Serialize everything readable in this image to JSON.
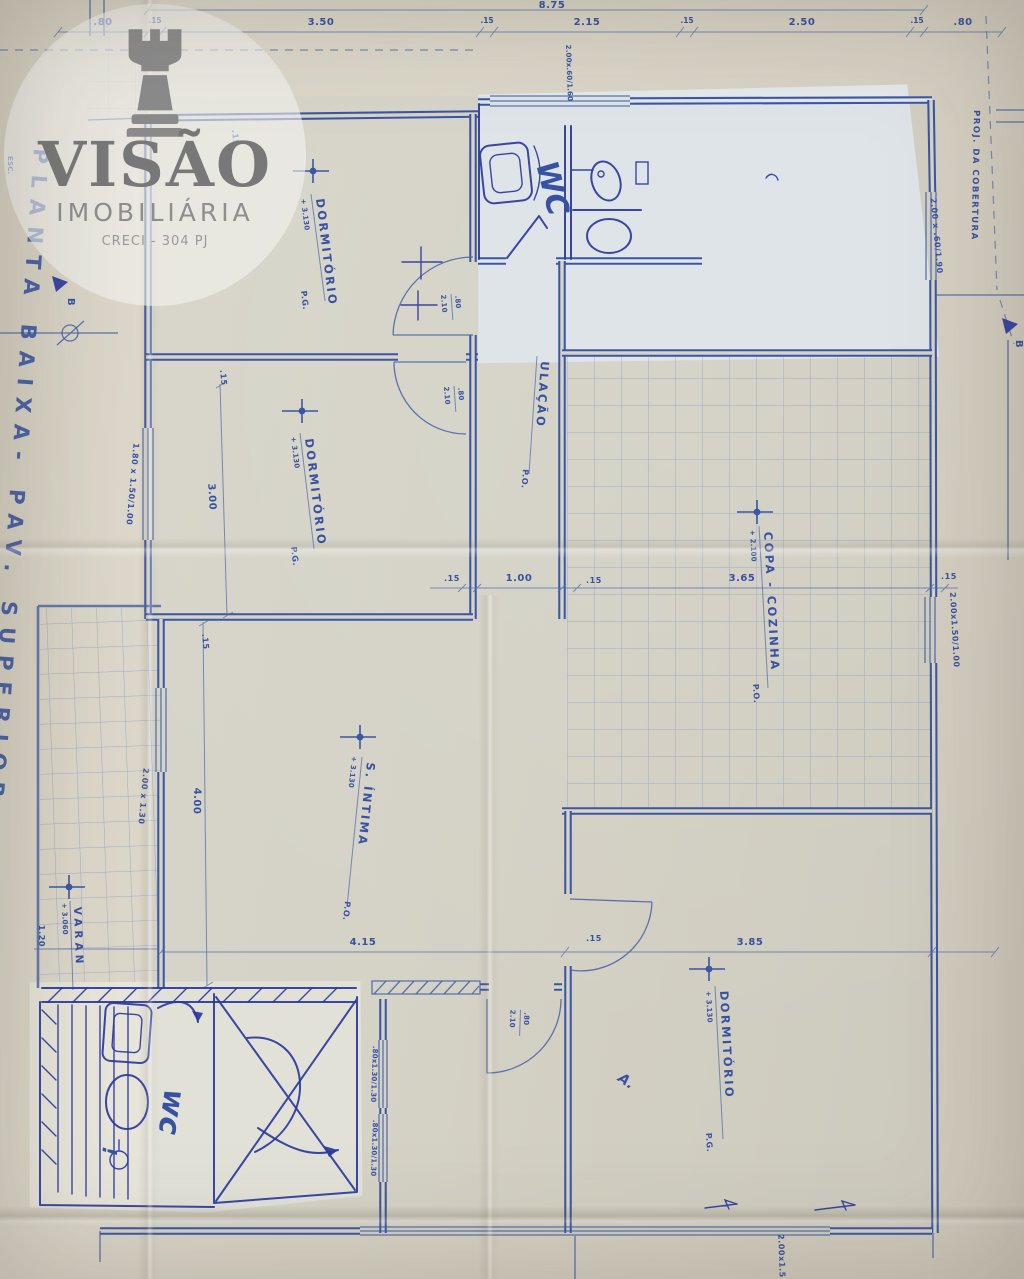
{
  "watermark": {
    "brand": "VISÃO",
    "subtitle": "IMOBILIÁRIA",
    "license": "CRECI - 304 PJ"
  },
  "margins": {
    "left_title": "PLANTA BAIXA- PAV. SUPERIOR",
    "left_scale": "ESC.",
    "right_title": "PROJ. DA COBERTURA",
    "section_left": "B",
    "section_right": "B"
  },
  "rooms": {
    "dorm1": {
      "label": "DORMITÓRIO",
      "elev": "+ 3.130",
      "floor": "P.G."
    },
    "dorm2": {
      "label": "DORMITÓRIO",
      "elev": "+ 3.130",
      "floor": "P.G."
    },
    "circ": {
      "label": "ULAÇÃO",
      "floor": "P.O."
    },
    "copa": {
      "label": "COPA - COZINHA",
      "elev": "+ 2.100",
      "floor": "P.O."
    },
    "intima": {
      "label": "S. ÍNTIMA",
      "elev": "+ 3.130",
      "floor": "P.O."
    },
    "dorm3": {
      "label": "DORMITÓRIO",
      "elev": "+ 3.130",
      "floor": "P.G."
    },
    "varanda": {
      "label": "VARAN",
      "elev": "+ 3.060"
    },
    "wc_upper": {
      "label": "WC"
    },
    "wc_lower": {
      "label": "wc",
      "mark": "!"
    }
  },
  "dims": {
    "total": "8.75",
    "top": [
      ".80",
      ".15",
      "3.50",
      ".15",
      "2.15",
      ".15",
      "2.50",
      ".15",
      ".80"
    ],
    "w300": "3.00",
    "w100": "1.00",
    "w365": "3.65",
    "h400": "4.00",
    "w415": "4.15",
    "w385": "3.85",
    "w120": "1.20",
    "t15": ".15",
    "door_w": ".80",
    "door_h": "2.10"
  },
  "windows": {
    "dorm2_left": "1.80 x 1.50/1.00",
    "intima_left": "2.00 x 1.30",
    "copa_right": "2.00x1.50/1.00",
    "room_right": "2.00 x .60/1.90",
    "bath_top": "2.00x.60/1.60",
    "hall_a": ".80x1.30/1.30",
    "hall_b": ".80x1.30/1.30",
    "bottom": "2.00x1.5"
  },
  "notes": {
    "a": "A."
  }
}
